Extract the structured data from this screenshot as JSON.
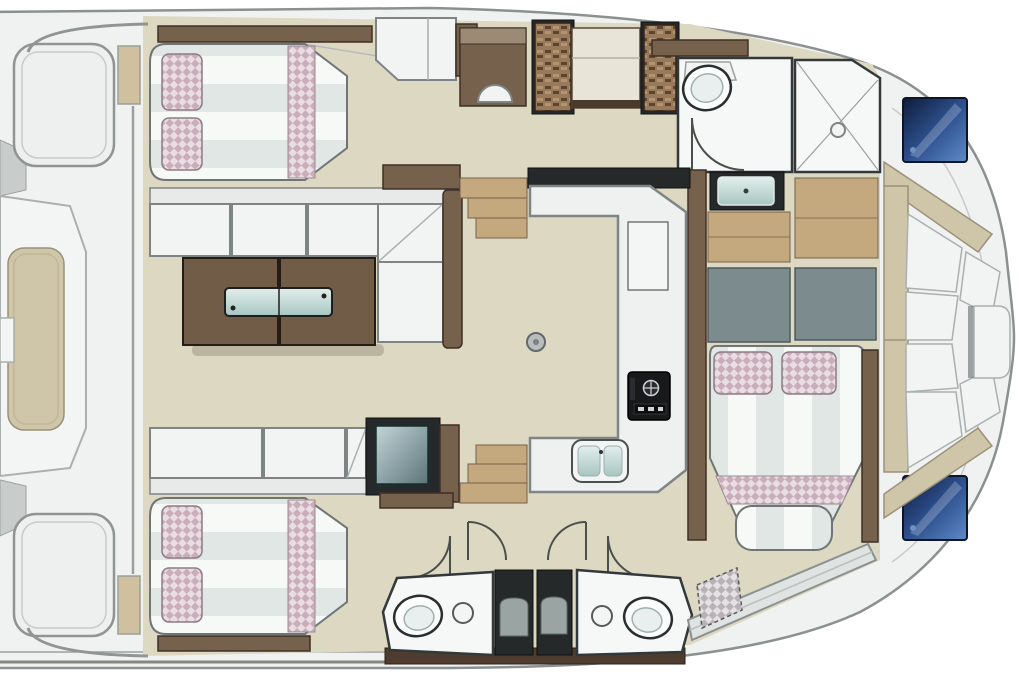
{
  "diagram": {
    "type": "floor-plan",
    "subject": "yacht interior layout, top-down view",
    "orientation": {
      "bow": "right",
      "stern": "left"
    },
    "areas": [
      {
        "id": "stern-deck",
        "elements": [
          "platform-outline",
          "sunpad-panel"
        ]
      },
      {
        "id": "aft-cabin-top",
        "elements": [
          "double-bed",
          "pillows",
          "headboard-shelf"
        ]
      },
      {
        "id": "salon",
        "elements": [
          "l-sofa",
          "folding-table",
          "glass-insert",
          "sofa-row",
          "media-unit"
        ]
      },
      {
        "id": "galley",
        "elements": [
          "u-counter",
          "stove",
          "double-sink",
          "counter-hatch",
          "floor-drain",
          "steps-up",
          "steps-down"
        ]
      },
      {
        "id": "head-top",
        "elements": [
          "toilet",
          "shower",
          "vanity-sink",
          "door-swing"
        ]
      },
      {
        "id": "wardrobes-top",
        "elements": [
          "rattan-locker",
          "shelf-unit",
          "rattan-locker",
          "desk",
          "stool"
        ]
      },
      {
        "id": "forward-cabin-right",
        "elements": [
          "double-bed",
          "pillows",
          "wood-floor-panels",
          "gray-lockers"
        ]
      },
      {
        "id": "aft-cabin-bottom",
        "elements": [
          "double-bed",
          "pillows",
          "foot-shelf"
        ]
      },
      {
        "id": "heads-bottom",
        "elements": [
          "toilet",
          "round-sink",
          "shower-stall",
          "shower-stall",
          "round-sink",
          "toilet",
          "door-swings"
        ]
      },
      {
        "id": "bow-lounge",
        "elements": [
          "u-seatback",
          "cushions",
          "center-seat",
          "deck-hatch",
          "deck-hatch"
        ]
      },
      {
        "id": "side-deck",
        "elements": [
          "step-band",
          "textured-mat"
        ]
      }
    ]
  },
  "palette": {
    "deck": "#f0f2f1",
    "hull_line": "#8b9191",
    "floor": "#ddd8c2",
    "wall_dark": "#26292a",
    "wood": "#75614c",
    "wood_dark": "#4e3d2e",
    "wood_light": "#c4a87e",
    "tan_seat": "#cfc5a9",
    "gray_panel": "#7c8b8e",
    "hatch_blue_dark": "#14264a",
    "hatch_blue_light": "#4674b8",
    "glass": "#bcd6d2",
    "pillow_pink": "#c9aeba",
    "pillow_light": "#e9dde3",
    "stripe": "#e1e7e4",
    "stall_dark": "#25292b",
    "sink_basin": "#d7e4e0"
  }
}
